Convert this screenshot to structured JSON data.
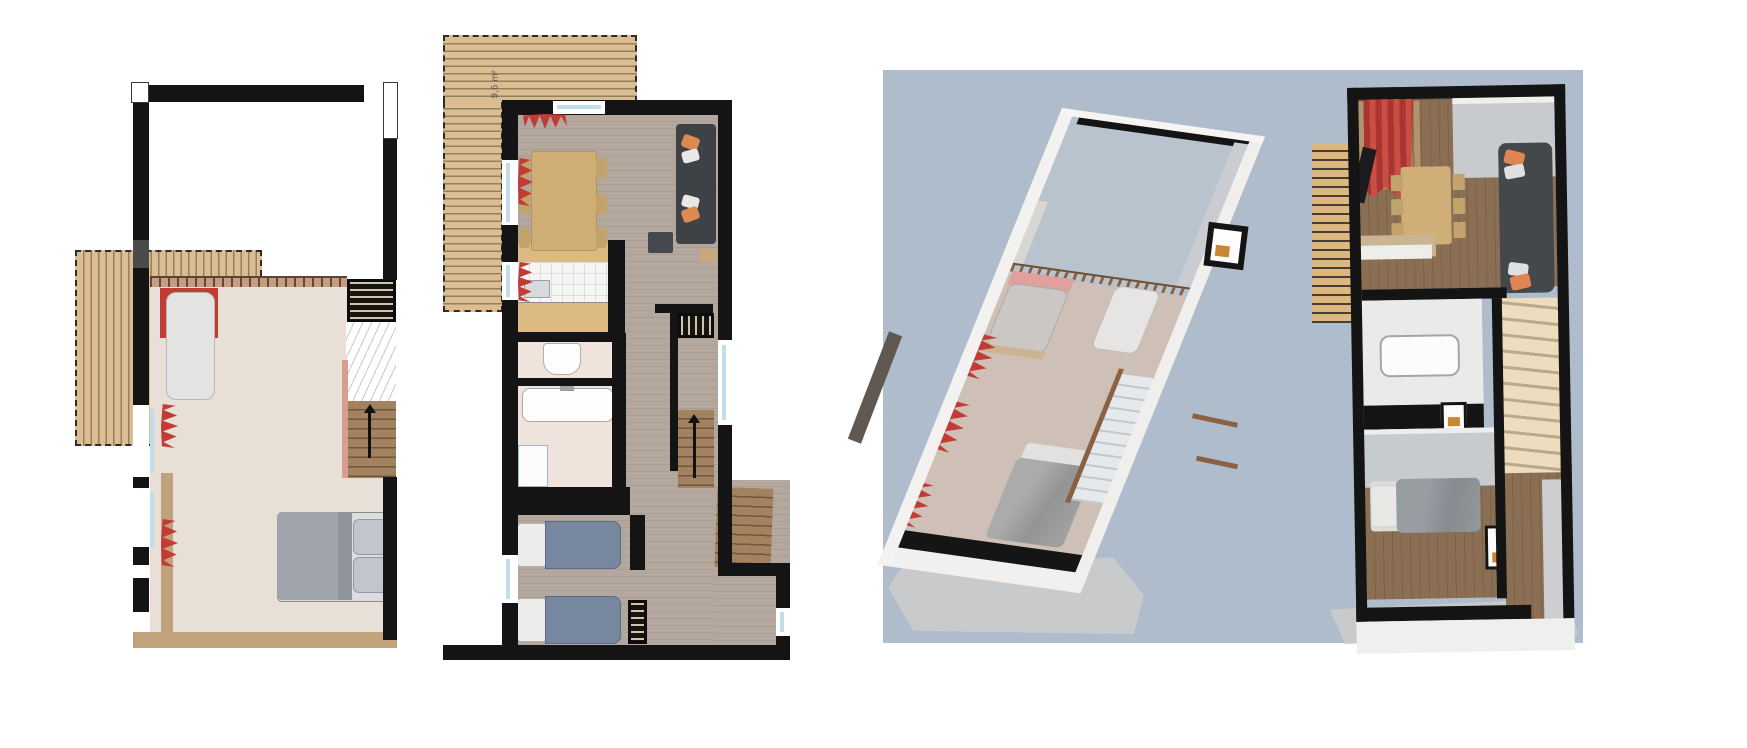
{
  "scene": {
    "width": 1747,
    "height": 748,
    "background": "#ffffff"
  },
  "plan_left": {
    "type": "2d-floorplan",
    "level": "upper-mezzanine"
  },
  "plan_middle": {
    "type": "2d-floorplan",
    "level": "main",
    "deck_area_label": "9,6 m²"
  },
  "panel_3d": {
    "type": "3d-dollhouse-render",
    "background": "#aebccc",
    "units": 2
  },
  "palette": {
    "wall_black": "#141414",
    "deck_wood": "#dcbd92",
    "floor_beige": "#e8dfd6",
    "floor_gray_wood": "#b3a79e",
    "floor_bath_pink": "#f0e3dc",
    "rug_tan": "#c0a37d",
    "curtain_red": "#c23b34",
    "sofa_charcoal": "#3e4247",
    "pillow_orange": "#dd8a50",
    "duvet_gray": "#a0a4ac",
    "duvet_blue": "#76879f",
    "stair_brown": "#a3825f",
    "sky_panel_blue": "#aebccc",
    "render_wall_white": "#f3f2f0",
    "render_floor_wood": "#8b6f54",
    "railing_brown": "#8a6243"
  }
}
